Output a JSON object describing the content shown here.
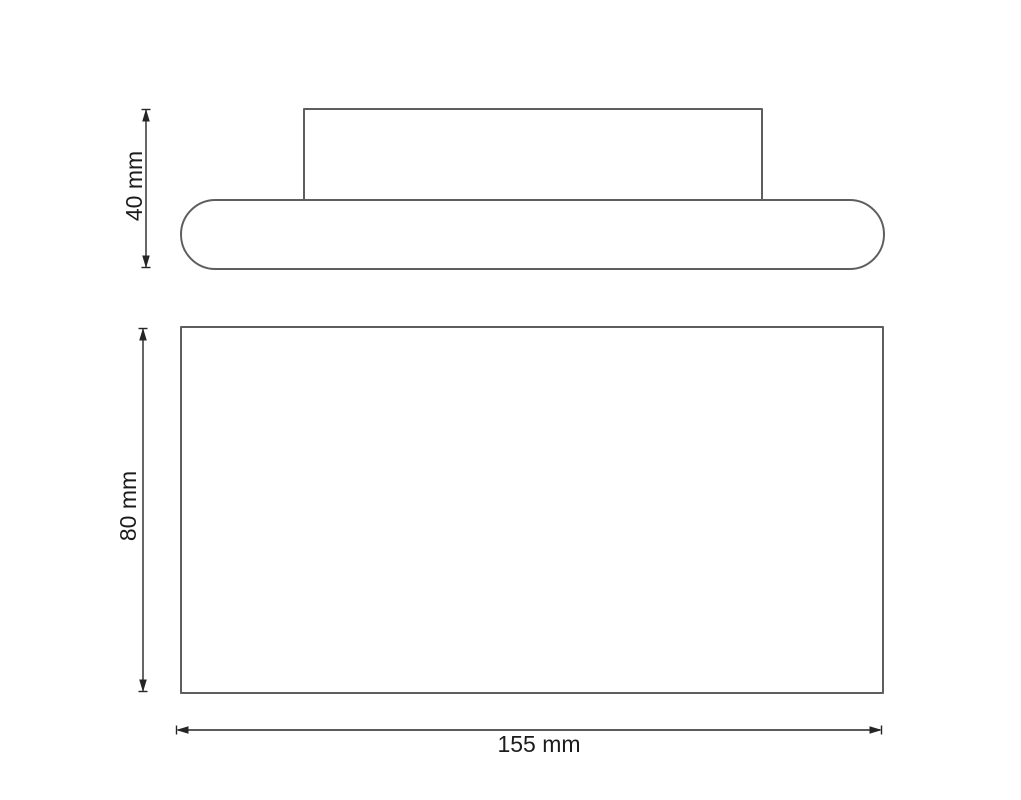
{
  "drawing": {
    "background": "#ffffff",
    "outline_color": "#5e5e5e",
    "dimension_color": "#252525",
    "text_color": "#1c1c1c",
    "views": [
      {
        "id": "side-view",
        "shapes": [
          "mounting-plate",
          "rounded-body"
        ],
        "dimensions": [
          {
            "label": "40 mm",
            "orientation": "vertical"
          }
        ]
      },
      {
        "id": "front-view",
        "shapes": [
          "front-face"
        ],
        "dimensions": [
          {
            "label": "80 mm",
            "orientation": "vertical"
          },
          {
            "label": "155 mm",
            "orientation": "horizontal"
          }
        ]
      }
    ]
  }
}
